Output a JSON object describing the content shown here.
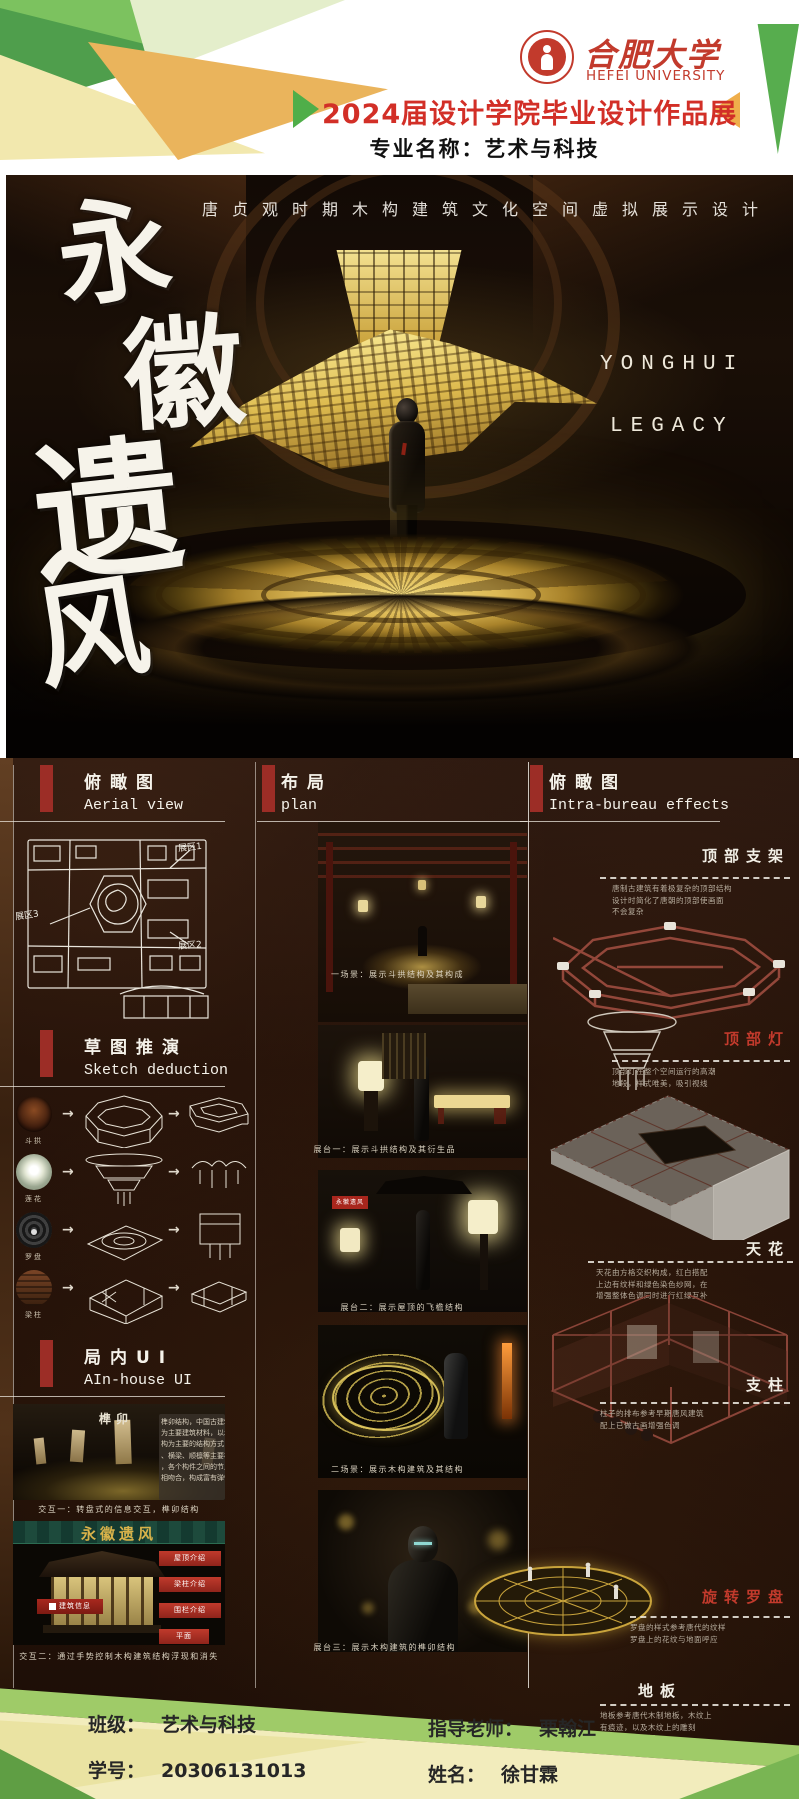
{
  "header": {
    "logo_cn": "合肥大学",
    "logo_en": "HEFEI UNIVERSITY",
    "banner": "2024届设计学院毕业设计作品展",
    "major": "专业名称：艺术与科技"
  },
  "hero": {
    "subtitle": "唐贞观时期木构建筑文化空间虚拟展示设计",
    "title_chars": [
      "永",
      "徽",
      "遗",
      "风"
    ],
    "title_en_line1": "YONGHUI",
    "title_en_line2": "LEGACY"
  },
  "left": {
    "aerial": {
      "cn": "俯瞰图",
      "en": "Aerial view",
      "zones": [
        "展区1",
        "展区2",
        "展区3"
      ]
    },
    "sketch": {
      "cn": "草图推演",
      "en": "Sketch deduction",
      "rows": [
        {
          "label": "斗拱"
        },
        {
          "label": "莲花"
        },
        {
          "label": "罗盘"
        },
        {
          "label": "梁柱"
        }
      ],
      "arrow": "→"
    },
    "ui": {
      "cn": "局内UI",
      "en": "AIn-house UI",
      "shot1": {
        "title": "榫卯",
        "panel_lines": [
          "榫卯结构，中国古建筑以木材",
          "为主要建筑材料，以木构架结",
          "构为主要的结构方式，由立柱",
          "、横梁、顺檩等主要构件建成",
          "，各个构件之间的节点以榫卯",
          "相吻合，构成富有弹性的框架"
        ],
        "caption": "交互一：转盘式的信息交互，榫卯结构"
      },
      "shot2": {
        "title": "永徽遗风",
        "tag": "建筑信息",
        "buttons": [
          "屋顶介绍",
          "梁柱介绍",
          "围栏介绍",
          "平面"
        ],
        "caption": "交互二：通过手势控制木构建筑结构浮现和消失"
      }
    }
  },
  "middle": {
    "cn": "布局",
    "en": "plan",
    "plaque": "永徽遗风",
    "captions": [
      "一场景：展示斗拱结构及其构成",
      "展台一：展示斗拱结构及其衍生品",
      "展台二：展示屋顶的飞檐结构",
      "二场景：展示木构建筑及其结构",
      "展台三：展示木构建筑的榫卯结构"
    ]
  },
  "right": {
    "cn": "俯瞰图",
    "en": "Intra-bureau effects",
    "items": [
      {
        "label": "顶部支架",
        "lines": [
          "唐制古建筑有着极复杂的顶部结构",
          "设计时简化了唐朝的顶部使画面",
          "不会复杂"
        ]
      },
      {
        "label": "顶部灯",
        "lines": [
          "顶部灯在整个空间运行的高潮",
          "地段，样式唯美，吸引视线"
        ]
      },
      {
        "label": "天花",
        "lines": [
          "天花由方格交织构成，红白搭配",
          "上边有纹样和绿色染色纱网，在",
          "增强整体色调同时进行红绿互补"
        ]
      },
      {
        "label": "支柱",
        "lines": [
          "柱子的排布参考早期唐风建筑",
          "配上已做古画增强色调"
        ]
      },
      {
        "label": "旋转罗盘",
        "lines": [
          "罗盘的样式参考唐代的纹样",
          "罗盘上的花纹与地面呼应"
        ]
      },
      {
        "label": "地板",
        "lines": [
          "地板参考唐代木制地板，木纹上",
          "有痕迹，以及木纹上的雕刻",
          "整体上呈暗色调"
        ]
      }
    ]
  },
  "footer": {
    "class_label": "班级：",
    "class_value": "艺术与科技",
    "advisor_label": "指导老师：",
    "advisor_value": "栗翰江",
    "sid_label": "学号：",
    "sid_value": "20306131013",
    "name_label": "姓名：",
    "name_value": "徐甘霖"
  },
  "colors": {
    "brand_red": "#c23a2c",
    "banner_red": "#d22f27",
    "gold": "#d9b44a",
    "green": "#5fae4e",
    "light_green": "#9fcb68",
    "cream": "#f2ecbc",
    "section_bar_red": "#9c2d26",
    "dark_bg": "#1f1008"
  }
}
